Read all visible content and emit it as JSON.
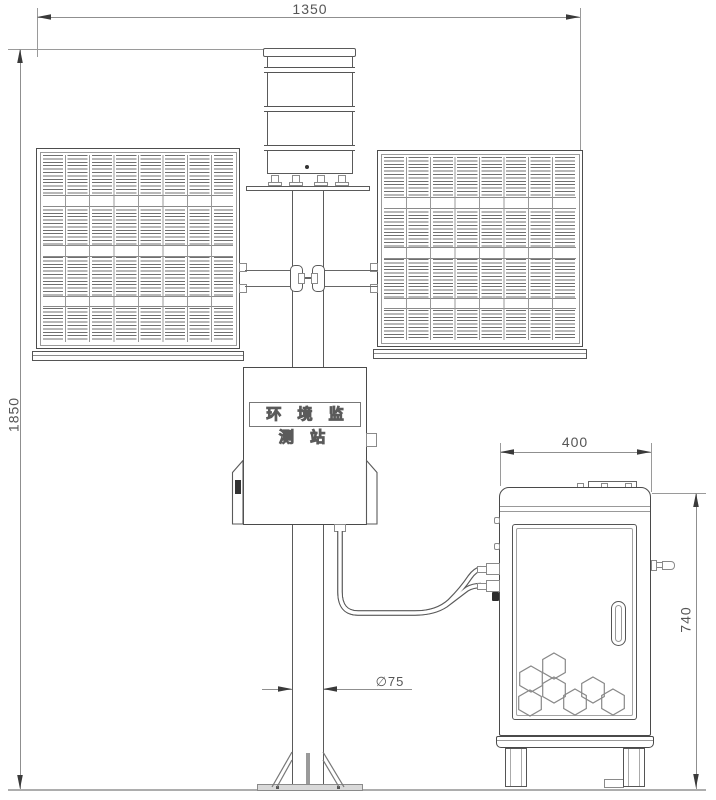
{
  "drawing_type": "engineering-installation-diagram",
  "labels": {
    "station_name": "环 境 监 测 站"
  },
  "dimensions": {
    "overall_width": "1350",
    "overall_height": "1850",
    "cabinet_width": "400",
    "cabinet_height": "740",
    "pole_diameter": "∅75"
  },
  "colors": {
    "object_line": "#5a5a5a",
    "dimension_line": "#8f8f8f",
    "background": "#ffffff"
  }
}
